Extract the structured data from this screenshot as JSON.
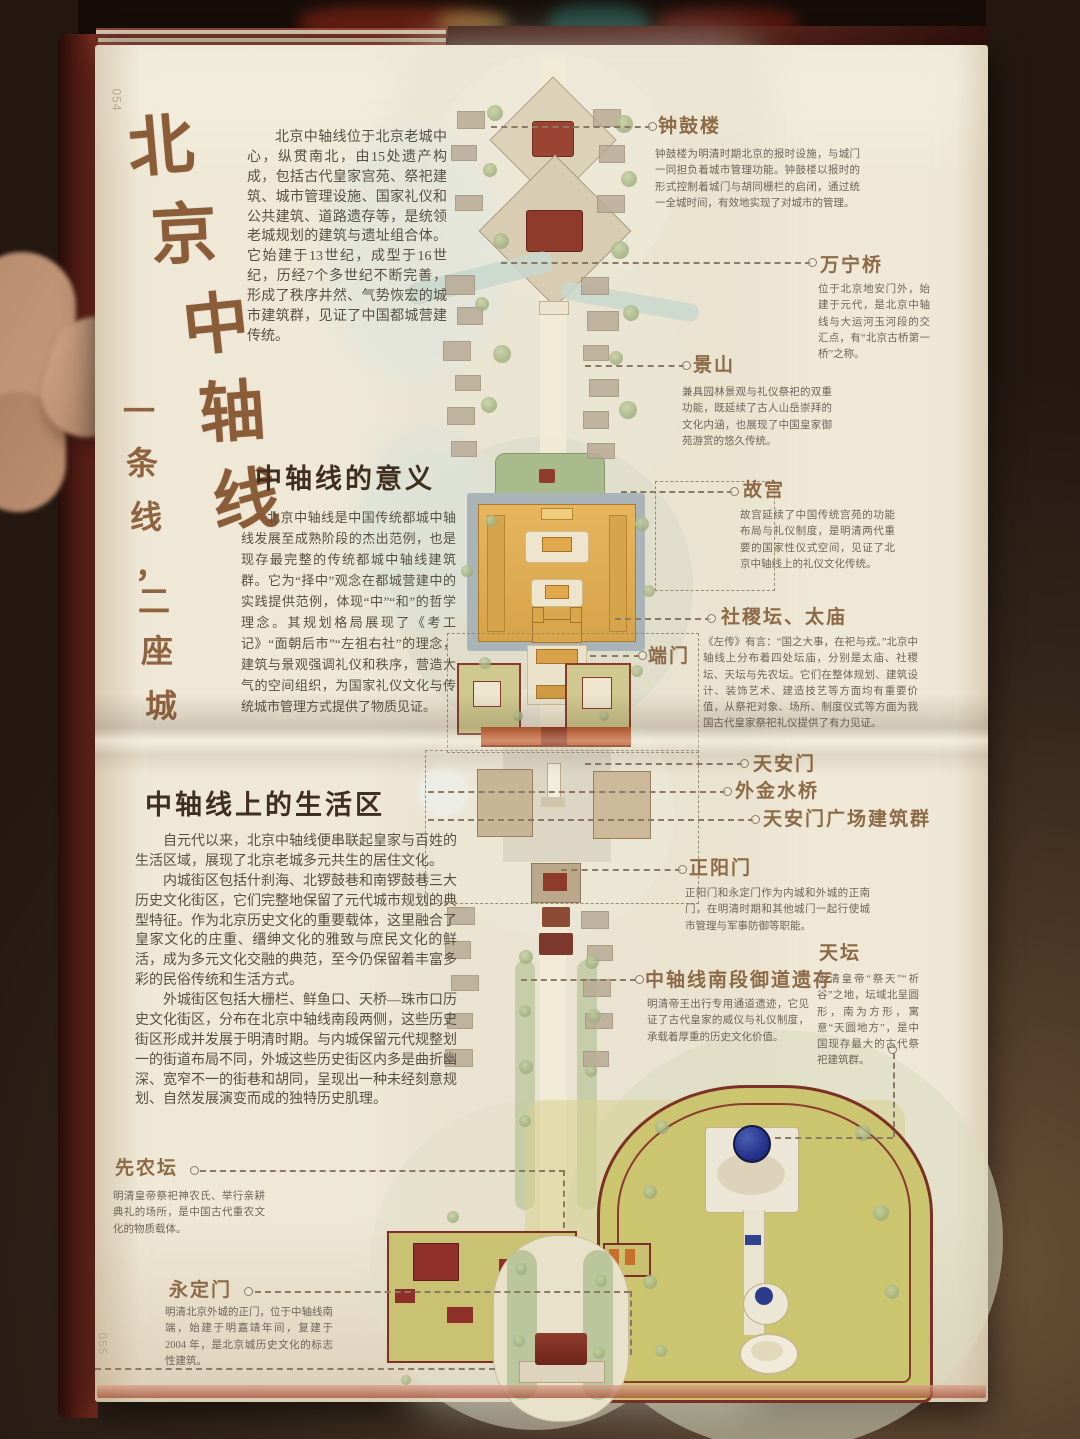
{
  "page_numbers": {
    "top": "054",
    "bottom": "055"
  },
  "title": {
    "main": "北京中轴线",
    "main_chars": [
      "北",
      "京",
      "中",
      "轴",
      "线"
    ],
    "sub": "一条线，二座城",
    "sub_chars": [
      "一",
      "条",
      "线",
      "，",
      "二",
      "座",
      "城"
    ]
  },
  "intro": "北京中轴线位于北京老城中心，纵贯南北，由15处遗产构成，包括古代皇家宫苑、祭祀建筑、城市管理设施、国家礼仪和公共建筑、道路遗存等，是统领老城规划的建筑与遗址组合体。它始建于13世纪，成型于16世纪，历经7个多世纪不断完善，形成了秩序井然、气势恢宏的城市建筑群，见证了中国都城营建传统。",
  "sections": {
    "meaning": {
      "heading": "中轴线的意义",
      "body": "北京中轴线是中国传统都城中轴线发展至成熟阶段的杰出范例，也是现存最完整的传统都城中轴线建筑群。它为“择中”观念在都城营建中的实践提供范例，体现“中”“和”的哲学理念。其规划格局展现了《考工记》“面朝后市”“左祖右社”的理念，建筑与景观强调礼仪和秩序，营造大气的空间组织，为国家礼仪文化与传统城市管理方式提供了物质见证。"
    },
    "living": {
      "heading": "中轴线上的生活区",
      "p1": "自元代以来，北京中轴线便串联起皇家与百姓的生活区域，展现了北京老城多元共生的居住文化。",
      "p2": "内城街区包括什刹海、北锣鼓巷和南锣鼓巷三大历史文化街区，它们完整地保留了元代城市规划的典型特征。作为北京历史文化的重要载体，这里融合了皇家文化的庄重、缙绅文化的雅致与庶民文化的鲜活，成为多元文化交融的典范，至今仍保留着丰富多彩的民俗传统和生活方式。",
      "p3": "外城街区包括大栅栏、鲜鱼口、天桥—珠市口历史文化街区，分布在北京中轴线南段两侧，这些历史街区形成并发展于明清时期。与内城保留元代规整划一的街道布局不同，外城这些历史街区内多是曲折幽深、宽窄不一的街巷和胡同，呈现出一种未经刻意规划、自然发展演变而成的独特历史肌理。"
    }
  },
  "annotations": {
    "zhonggulou": {
      "label": "钟鼓楼",
      "desc": "钟鼓楼为明清时期北京的报时设施，与城门一同担负着城市管理功能。钟鼓楼以报时的形式控制着城门与胡同栅栏的启闭，通过统一全城时间，有效地实现了对城市的管理。"
    },
    "wanningqiao": {
      "label": "万宁桥",
      "desc": "位于北京地安门外，始建于元代，是北京中轴线与大运河玉河段的交汇点，有“北京古桥第一桥”之称。"
    },
    "jingshan": {
      "label": "景山",
      "desc": "兼具园林景观与礼仪祭祀的双重功能，既延续了古人山岳崇拜的文化内涵，也展现了中国皇家御苑游赏的悠久传统。"
    },
    "gugong": {
      "label": "故宫",
      "desc": "故宫延续了中国传统宫苑的功能布局与礼仪制度，是明清两代重要的国家性仪式空间，见证了北京中轴线上的礼仪文化传统。"
    },
    "sheji_taimiao": {
      "label": "社稷坛、太庙",
      "desc": "《左传》有言：“国之大事，在祀与戎。”北京中轴线上分布着四处坛庙，分别是太庙、社稷坛、天坛与先农坛。它们在整体规划、建筑设计、装饰艺术、建造技艺等方面均有重要价值，从祭祀对象、场所、制度仪式等方面为我国古代皇家祭祀礼仪提供了有力见证。"
    },
    "duanmen": {
      "label": "端门"
    },
    "tiananmen": {
      "label": "天安门"
    },
    "waijinshuiqiao": {
      "label": "外金水桥"
    },
    "guangchangqun": {
      "label": "天安门广场建筑群"
    },
    "zhengyangmen": {
      "label": "正阳门",
      "desc": "正阳门和永定门作为内城和外城的正南门，在明清时期和其他城门一起行使城市管理与军事防御等职能。"
    },
    "tiantan": {
      "label": "天坛",
      "desc": "明清皇帝“祭天”“祈谷”之地，坛域北呈圆形，南为方形，寓意“天圆地方”，是中国现存最大的古代祭祀建筑群。"
    },
    "yudao": {
      "label": "中轴线南段御道遗存",
      "desc": "明清帝王出行专用通道遗迹，它见证了古代皇家的威仪与礼仪制度，承载着厚重的历史文化价值。"
    },
    "xiannongtan": {
      "label": "先农坛",
      "desc": "明清皇帝祭祀神农氏、举行亲耕典礼的场所，是中国古代重农文化的物质载体。"
    },
    "yongdingmen": {
      "label": "永定门",
      "desc": "明清北京外城的正门，位于中轴线南端，始建于明嘉靖年间，复建于 2004 年，是北京城历史文化的标志性建筑。"
    }
  },
  "colors": {
    "accent_bronze": "#8c6a47",
    "page_paper": "#efe8d6",
    "map_roof_red": "#8e3b2c",
    "forbidden_city_gold": "#d9a64c",
    "temple_blue": "#2c3a8c"
  }
}
